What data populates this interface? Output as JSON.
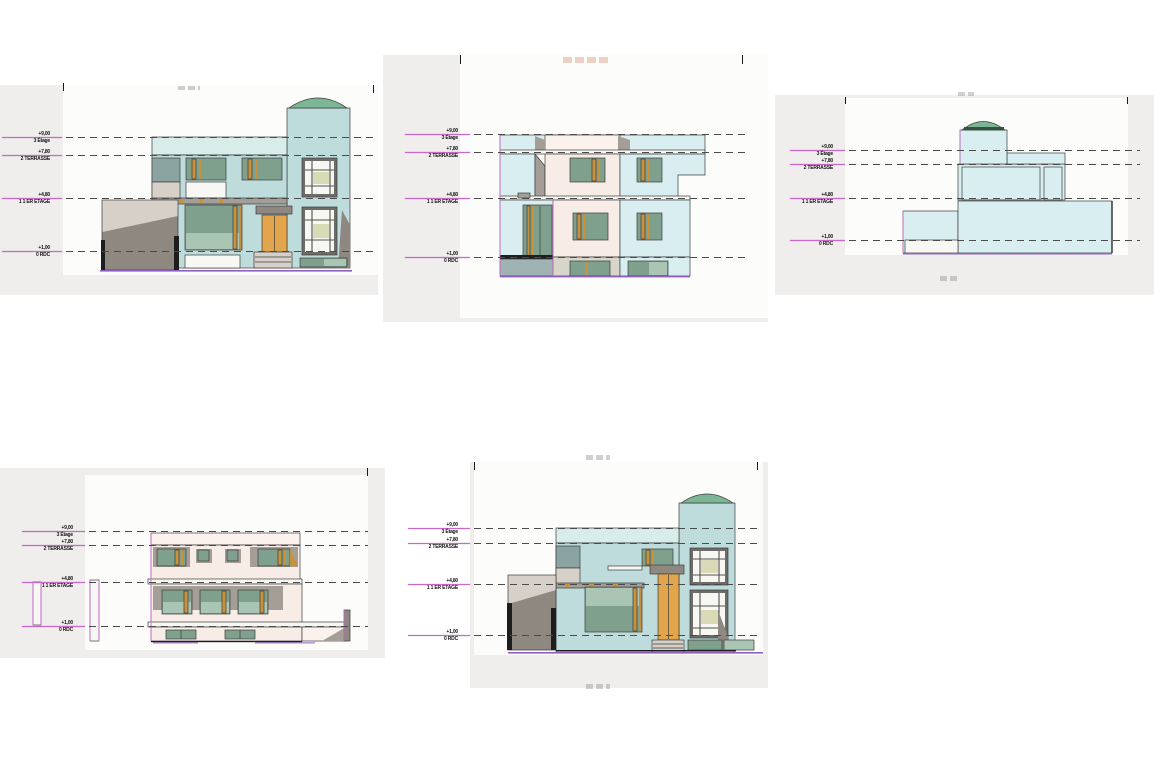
{
  "levels": [
    {
      "value": "+9,00",
      "name": "3 Étage"
    },
    {
      "value": "+7,80",
      "name": "2 TERRASSE"
    },
    {
      "value": "+4,80",
      "name": "1 1 ER ETAGE"
    },
    {
      "value": "+1,00",
      "name": "0 RDC"
    }
  ],
  "colors": {
    "panel_bg": "#efeeec",
    "sheet_white": "#fcfcfb",
    "wall_cyan": "#bfdcdc",
    "wall_cyan_light": "#d9eef0",
    "fascia_light": "#d8ece9",
    "pink_wall": "#f8ece6",
    "pink_light": "#fbf2ee",
    "glass": "#7fa08c",
    "glass_light": "#aac5b3",
    "frame_orange": "#c8913d",
    "door_orange": "#e2a54b",
    "shadow_dark": "#8f8881",
    "shadow_mid": "#a59e96",
    "shadow_light": "#d6d0c9",
    "gray_teal": "#8ba4a2",
    "dome_green": "#7db694",
    "pane_khaki": "#d8dbb6",
    "outline": "#3c3c3c",
    "level_magenta": "#c869c8",
    "dash_gray": "#4a4a4a",
    "ground_purple": "#8f5fc0"
  }
}
